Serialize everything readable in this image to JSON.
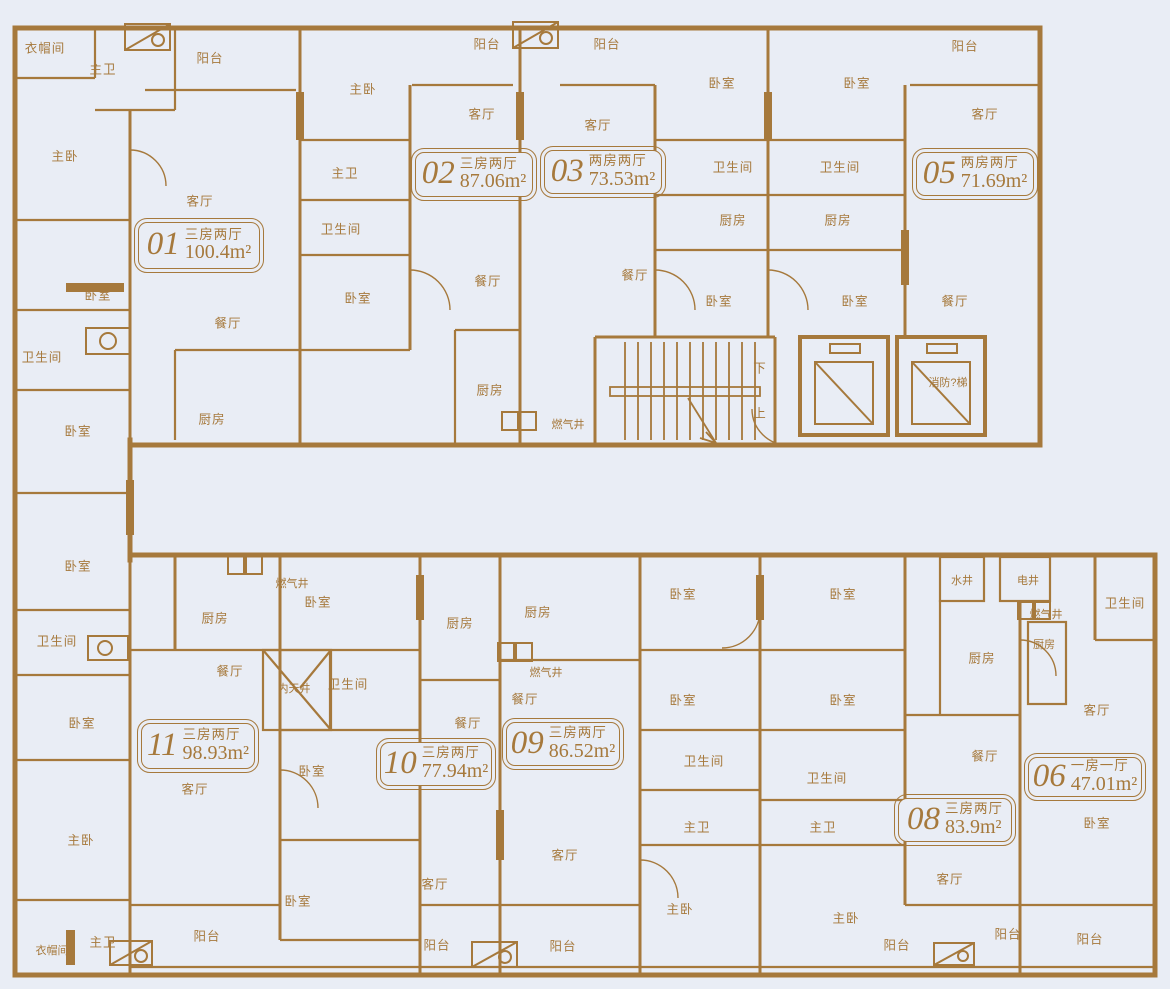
{
  "drawing_title": "residential-floor-plan",
  "colors": {
    "background": "#e9edf5",
    "wall": "#a6793c",
    "text": "#a6793c"
  },
  "units": [
    {
      "no": "01",
      "layout": "三房两厅",
      "area": "100.4m²",
      "x": 138,
      "y": 222,
      "w": 122,
      "h": 47
    },
    {
      "no": "02",
      "layout": "三房两厅",
      "area": "87.06m²",
      "x": 415,
      "y": 152,
      "w": 118,
      "h": 45
    },
    {
      "no": "03",
      "layout": "两房两厅",
      "area": "73.53m²",
      "x": 544,
      "y": 150,
      "w": 118,
      "h": 44
    },
    {
      "no": "05",
      "layout": "两房两厅",
      "area": "71.69m²",
      "x": 916,
      "y": 152,
      "w": 118,
      "h": 44
    },
    {
      "no": "11",
      "layout": "三房两厅",
      "area": "98.93m²",
      "x": 141,
      "y": 723,
      "w": 114,
      "h": 46
    },
    {
      "no": "10",
      "layout": "三房两厅",
      "area": "77.94m²",
      "x": 380,
      "y": 742,
      "w": 112,
      "h": 44
    },
    {
      "no": "09",
      "layout": "三房两厅",
      "area": "86.52m²",
      "x": 506,
      "y": 722,
      "w": 114,
      "h": 44
    },
    {
      "no": "08",
      "layout": "三房两厅",
      "area": "83.9m²",
      "x": 898,
      "y": 798,
      "w": 114,
      "h": 44
    },
    {
      "no": "06",
      "layout": "一房一厅",
      "area": "47.01m²",
      "x": 1028,
      "y": 757,
      "w": 114,
      "h": 40
    }
  ],
  "core_labels": {
    "stair_down": "下",
    "stair_up": "上",
    "fire_elevator": "消防?梯"
  },
  "room_labels": [
    {
      "label": "衣帽间",
      "x": 45,
      "y": 47
    },
    {
      "label": "主卫",
      "x": 103,
      "y": 68
    },
    {
      "label": "阳台",
      "x": 210,
      "y": 57
    },
    {
      "label": "主卧",
      "x": 65,
      "y": 155
    },
    {
      "label": "客厅",
      "x": 200,
      "y": 200
    },
    {
      "label": "卧室",
      "x": 98,
      "y": 294
    },
    {
      "label": "餐厅",
      "x": 228,
      "y": 322
    },
    {
      "label": "卫生间",
      "x": 42,
      "y": 356
    },
    {
      "label": "厨房",
      "x": 212,
      "y": 418
    },
    {
      "label": "卧室",
      "x": 78,
      "y": 430
    },
    {
      "label": "主卧",
      "x": 363,
      "y": 88
    },
    {
      "label": "主卫",
      "x": 345,
      "y": 172
    },
    {
      "label": "卫生间",
      "x": 341,
      "y": 228
    },
    {
      "label": "卧室",
      "x": 358,
      "y": 297
    },
    {
      "label": "阳台",
      "x": 487,
      "y": 43
    },
    {
      "label": "客厅",
      "x": 482,
      "y": 113
    },
    {
      "label": "餐厅",
      "x": 488,
      "y": 280
    },
    {
      "label": "厨房",
      "x": 490,
      "y": 389
    },
    {
      "label": "燃气井",
      "x": 568,
      "y": 424,
      "small": true
    },
    {
      "label": "阳台",
      "x": 607,
      "y": 43
    },
    {
      "label": "客厅",
      "x": 598,
      "y": 124
    },
    {
      "label": "餐厅",
      "x": 635,
      "y": 274
    },
    {
      "label": "卧室",
      "x": 722,
      "y": 82
    },
    {
      "label": "卫生间",
      "x": 733,
      "y": 166
    },
    {
      "label": "厨房",
      "x": 733,
      "y": 219
    },
    {
      "label": "卧室",
      "x": 719,
      "y": 300
    },
    {
      "label": "卧室",
      "x": 857,
      "y": 82
    },
    {
      "label": "卫生间",
      "x": 840,
      "y": 166
    },
    {
      "label": "厨房",
      "x": 838,
      "y": 219
    },
    {
      "label": "卧室",
      "x": 855,
      "y": 300
    },
    {
      "label": "阳台",
      "x": 965,
      "y": 45
    },
    {
      "label": "客厅",
      "x": 985,
      "y": 113
    },
    {
      "label": "餐厅",
      "x": 955,
      "y": 300
    },
    {
      "label": "下",
      "x": 760,
      "y": 367
    },
    {
      "label": "上",
      "x": 760,
      "y": 412
    },
    {
      "label": "消防?梯",
      "x": 948,
      "y": 382,
      "small": true
    },
    {
      "label": "卧室",
      "x": 78,
      "y": 565
    },
    {
      "label": "卫生间",
      "x": 57,
      "y": 640
    },
    {
      "label": "卧室",
      "x": 82,
      "y": 722
    },
    {
      "label": "主卧",
      "x": 81,
      "y": 839
    },
    {
      "label": "衣帽间",
      "x": 52,
      "y": 950,
      "small": true
    },
    {
      "label": "主卫",
      "x": 103,
      "y": 941
    },
    {
      "label": "厨房",
      "x": 215,
      "y": 617
    },
    {
      "label": "燃气井",
      "x": 292,
      "y": 583,
      "small": true
    },
    {
      "label": "餐厅",
      "x": 230,
      "y": 670
    },
    {
      "label": "内天井",
      "x": 294,
      "y": 688,
      "small": true
    },
    {
      "label": "客厅",
      "x": 195,
      "y": 788
    },
    {
      "label": "阳台",
      "x": 207,
      "y": 935
    },
    {
      "label": "卧室",
      "x": 318,
      "y": 601
    },
    {
      "label": "卫生间",
      "x": 348,
      "y": 683
    },
    {
      "label": "卧室",
      "x": 312,
      "y": 770
    },
    {
      "label": "卧室",
      "x": 298,
      "y": 900
    },
    {
      "label": "厨房",
      "x": 460,
      "y": 622
    },
    {
      "label": "餐厅",
      "x": 468,
      "y": 722
    },
    {
      "label": "客厅",
      "x": 435,
      "y": 883
    },
    {
      "label": "阳台",
      "x": 437,
      "y": 944
    },
    {
      "label": "厨房",
      "x": 538,
      "y": 611
    },
    {
      "label": "燃气井",
      "x": 546,
      "y": 672,
      "small": true
    },
    {
      "label": "餐厅",
      "x": 525,
      "y": 698
    },
    {
      "label": "客厅",
      "x": 565,
      "y": 854
    },
    {
      "label": "阳台",
      "x": 563,
      "y": 945
    },
    {
      "label": "卧室",
      "x": 683,
      "y": 593
    },
    {
      "label": "卧室",
      "x": 683,
      "y": 699
    },
    {
      "label": "卫生间",
      "x": 704,
      "y": 760
    },
    {
      "label": "主卫",
      "x": 697,
      "y": 826
    },
    {
      "label": "主卧",
      "x": 680,
      "y": 908
    },
    {
      "label": "卧室",
      "x": 843,
      "y": 593
    },
    {
      "label": "卧室",
      "x": 843,
      "y": 699
    },
    {
      "label": "卫生间",
      "x": 827,
      "y": 777
    },
    {
      "label": "主卫",
      "x": 823,
      "y": 826
    },
    {
      "label": "主卧",
      "x": 846,
      "y": 917
    },
    {
      "label": "水井",
      "x": 962,
      "y": 580,
      "small": true
    },
    {
      "label": "电井",
      "x": 1028,
      "y": 580,
      "small": true
    },
    {
      "label": "燃气井",
      "x": 1046,
      "y": 614,
      "small": true
    },
    {
      "label": "厨房",
      "x": 982,
      "y": 657
    },
    {
      "label": "厨房",
      "x": 1044,
      "y": 644,
      "small": true
    },
    {
      "label": "餐厅",
      "x": 985,
      "y": 755
    },
    {
      "label": "客厅",
      "x": 950,
      "y": 878
    },
    {
      "label": "阳台",
      "x": 897,
      "y": 944
    },
    {
      "label": "卫生间",
      "x": 1125,
      "y": 602
    },
    {
      "label": "客厅",
      "x": 1097,
      "y": 709
    },
    {
      "label": "卧室",
      "x": 1097,
      "y": 822
    },
    {
      "label": "阳台",
      "x": 1008,
      "y": 933
    },
    {
      "label": "阳台",
      "x": 1090,
      "y": 938
    }
  ]
}
